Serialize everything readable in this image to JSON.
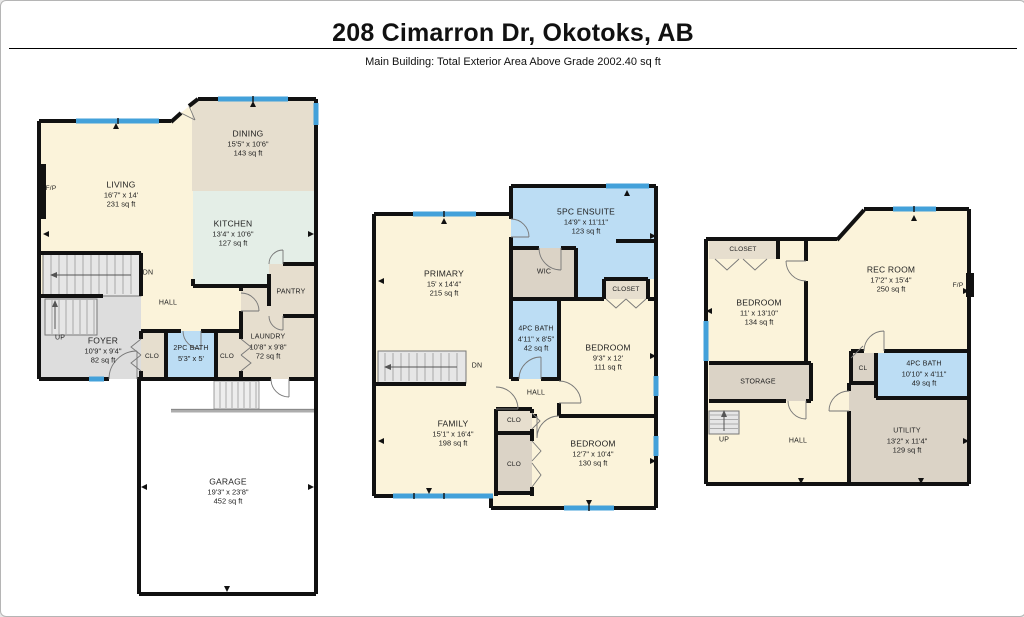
{
  "header": {
    "title": "208 Cimarron Dr, Okotoks, AB",
    "subtitle": "Main Building: Total Exterior Area Above Grade 2002.40 sq ft"
  },
  "palette": {
    "wall": "#111111",
    "room_cream": "#FBF3DA",
    "room_tan": "#E6DECE",
    "room_taupe": "#DBD3C6",
    "room_gray": "#DDDDDD",
    "kitchen_mint": "#E4EEE7",
    "bath_blue": "#BCDDF4",
    "window_blue": "#43A1DA",
    "garage_white": "#FFFFFF"
  },
  "floor1": {
    "living": {
      "name": "LIVING",
      "dims": "16'7\" x 14'",
      "area": "231 sq ft"
    },
    "dining": {
      "name": "DINING",
      "dims": "15'5\" x 10'6\"",
      "area": "143 sq ft"
    },
    "kitchen": {
      "name": "KITCHEN",
      "dims": "13'4\" x 10'6\"",
      "area": "127 sq ft"
    },
    "pantry": {
      "name": "PANTRY"
    },
    "hall": {
      "name": "HALL"
    },
    "foyer": {
      "name": "FOYER",
      "dims": "10'9\" x 9'4\"",
      "area": "82 sq ft"
    },
    "closet_left": {
      "name": "CLO"
    },
    "bath": {
      "name": "2PC BATH",
      "dims": "5'3\" x 5'"
    },
    "closet_right": {
      "name": "CLO"
    },
    "laundry": {
      "name": "LAUNDRY",
      "dims": "10'8\" x 9'8\"",
      "area": "72 sq ft"
    },
    "garage": {
      "name": "GARAGE",
      "dims": "19'3\" x 23'8\"",
      "area": "452 sq ft"
    },
    "stairs_down": {
      "name": "DN"
    },
    "stairs_up": {
      "name": "UP"
    },
    "fireplace": {
      "name": "F/P"
    }
  },
  "floor2": {
    "primary": {
      "name": "PRIMARY",
      "dims": "15' x 14'4\"",
      "area": "215 sq ft"
    },
    "ensuite": {
      "name": "5PC ENSUITE",
      "dims": "14'9\" x 11'11\"",
      "area": "123 sq ft"
    },
    "wic": {
      "name": "WIC"
    },
    "closet": {
      "name": "CLOSET"
    },
    "bath": {
      "name": "4PC BATH",
      "dims": "4'11\" x 8'5\"",
      "area": "42 sq ft"
    },
    "bedroom_upper": {
      "name": "BEDROOM",
      "dims": "9'3\" x 12'",
      "area": "111 sq ft"
    },
    "family": {
      "name": "FAMILY",
      "dims": "15'1\" x 16'4\"",
      "area": "198 sq ft"
    },
    "hall": {
      "name": "HALL"
    },
    "closet_a": {
      "name": "CLO"
    },
    "closet_b": {
      "name": "CLO"
    },
    "bedroom_lower": {
      "name": "BEDROOM",
      "dims": "12'7\" x 10'4\"",
      "area": "130 sq ft"
    },
    "stairs_down": {
      "name": "DN"
    }
  },
  "floor3": {
    "closet": {
      "name": "CLOSET"
    },
    "bedroom": {
      "name": "BEDROOM",
      "dims": "11' x 13'10\"",
      "area": "134 sq ft"
    },
    "rec_room": {
      "name": "REC ROOM",
      "dims": "17'2\" x 15'4\"",
      "area": "250 sq ft"
    },
    "storage": {
      "name": "STORAGE"
    },
    "hall": {
      "name": "HALL"
    },
    "closet_small": {
      "name": "CL"
    },
    "bath": {
      "name": "4PC BATH",
      "dims": "10'10\" x 4'11\"",
      "area": "49 sq ft"
    },
    "utility": {
      "name": "UTILITY",
      "dims": "13'2\" x 11'4\"",
      "area": "129 sq ft"
    },
    "stairs_up": {
      "name": "UP"
    },
    "fireplace": {
      "name": "F/P"
    }
  }
}
